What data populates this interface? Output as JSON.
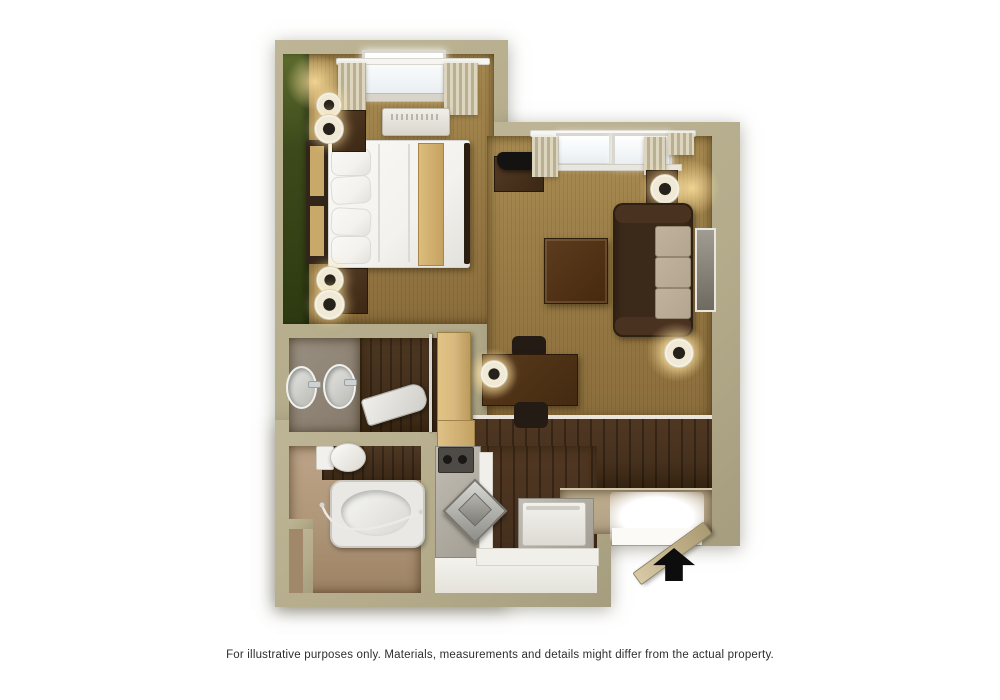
{
  "caption": {
    "text": "For illustrative purposes only.  Materials, measurements and details might differ from the actual property."
  },
  "palette": {
    "outside": "#ffffff",
    "wall": "#b3ab8a",
    "carpet": "#9a7d47",
    "hardwood": "#46311e",
    "bathroom_floor": "#b0977a",
    "accent_wall_green": "#3c4a1b",
    "entry_landing": "#b2a084",
    "linens_white": "#f3f2ee",
    "sofa_brown": "#3b2919",
    "cushion_tan": "#b3a58f",
    "closet_door_tan": "#d9b97f",
    "arrow_black": "#0d0d0d"
  },
  "symbols": {
    "entrance_arrow_direction": "up"
  }
}
